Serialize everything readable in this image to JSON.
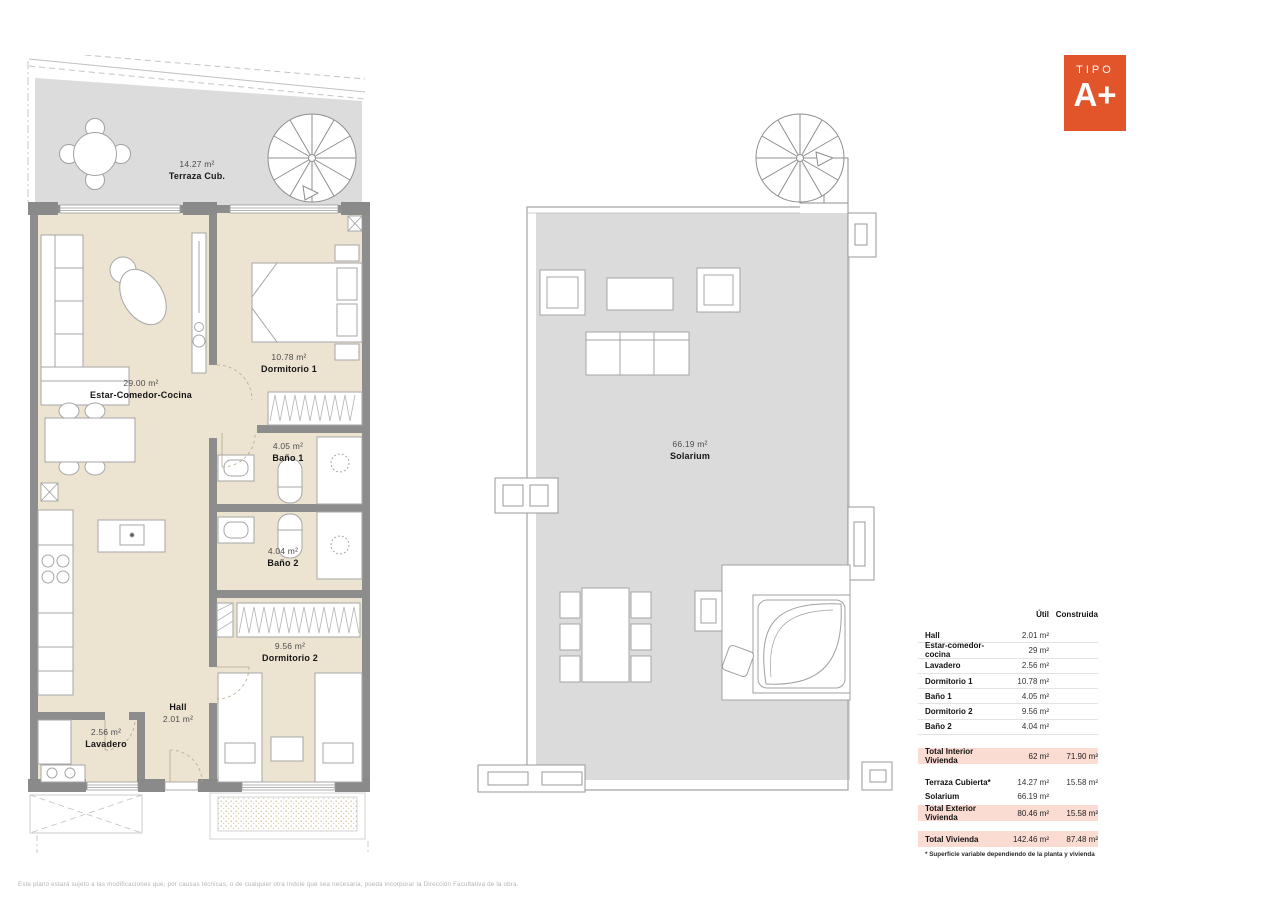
{
  "badge": {
    "line1": "TIPO",
    "line2": "A+",
    "color": "#e2552b"
  },
  "colors": {
    "accent": "#e2552b",
    "room_fill": "#ece3d1",
    "terrace_fill": "#dcdcdc",
    "wall": "#8d8d8d",
    "table_highlight": "#fbdcd2"
  },
  "rooms": {
    "terraza": {
      "area": "14.27 m²",
      "name": "Terraza Cub."
    },
    "estar": {
      "area": "29.00 m²",
      "name": "Estar-Comedor-Cocina"
    },
    "dormitorio1": {
      "area": "10.78 m²",
      "name": "Dormitorio 1"
    },
    "bano1": {
      "area": "4.05 m²",
      "name": "Baño 1"
    },
    "bano2": {
      "area": "4.04 m²",
      "name": "Baño 2"
    },
    "dormitorio2": {
      "area": "9.56 m²",
      "name": "Dormitorio 2"
    },
    "hall": {
      "name": "Hall",
      "area": "2.01 m²"
    },
    "lavadero": {
      "area": "2.56 m²",
      "name": "Lavadero"
    },
    "solarium": {
      "area": "66.19 m²",
      "name": "Solarium"
    }
  },
  "table": {
    "col_util": "Útil",
    "col_construida": "Construida",
    "rows": [
      {
        "label": "Hall",
        "util": "2.01 m²",
        "construida": ""
      },
      {
        "label": "Estar-comedor-cocina",
        "util": "29 m²",
        "construida": ""
      },
      {
        "label": "Lavadero",
        "util": "2.56 m²",
        "construida": ""
      },
      {
        "label": "Dormitorio 1",
        "util": "10.78 m²",
        "construida": ""
      },
      {
        "label": "Baño 1",
        "util": "4.05 m²",
        "construida": ""
      },
      {
        "label": "Dormitorio 2",
        "util": "9.56 m²",
        "construida": ""
      },
      {
        "label": "Baño 2",
        "util": "4.04 m²",
        "construida": ""
      }
    ],
    "total_interior": {
      "label": "Total Interior Vivienda",
      "util": "62 m²",
      "construida": "71.90 m²"
    },
    "exterior_rows": [
      {
        "label": "Terraza Cubierta*",
        "util": "14.27 m²",
        "construida": "15.58 m²"
      },
      {
        "label": "Solarium",
        "util": "66.19 m²",
        "construida": ""
      }
    ],
    "total_exterior": {
      "label": "Total Exterior Vivienda",
      "util": "80.46 m²",
      "construida": "15.58 m²"
    },
    "total_vivienda": {
      "label": "Total Vivienda",
      "util": "142.46 m²",
      "construida": "87.48 m²"
    },
    "footnote": "* Superficie variable dependiendo de la planta y vivienda"
  },
  "disclaimer": "Este plano estará sujeto a las modificaciones que, por causas técnicas, o de cualquier otra índole que sea necesaria, pueda incorporar la Dirección Facultativa de la obra."
}
